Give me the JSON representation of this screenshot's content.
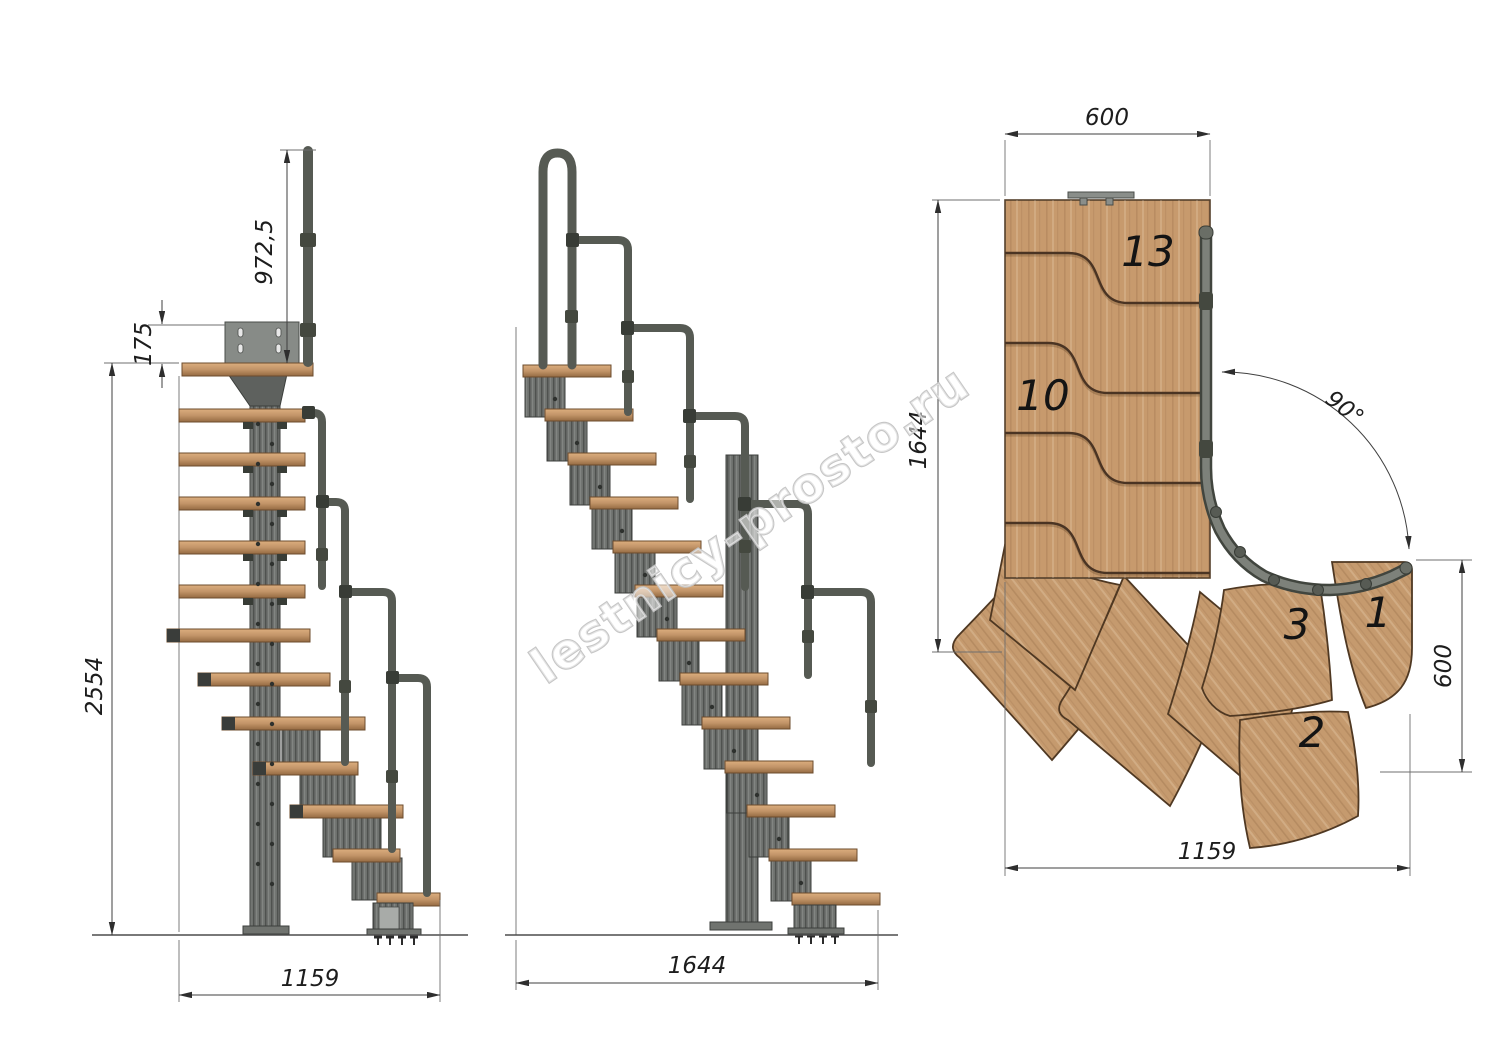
{
  "watermark": {
    "text": "lestnicy-prosto.ru"
  },
  "views": {
    "front": {
      "name": "front-elevation",
      "dims": {
        "handrail_height": "972,5",
        "mount_plate_height": "175",
        "total_height": "2554",
        "base_width": "1159"
      }
    },
    "side": {
      "name": "side-elevation",
      "dims": {
        "total_depth": "1644"
      }
    },
    "plan": {
      "name": "top-plan",
      "dims": {
        "flight_width": "600",
        "plan_depth": "1644",
        "turn_angle": "90°",
        "exit_width": "600",
        "plan_width": "1159"
      },
      "step_numbers": {
        "n13": "13",
        "n10": "10",
        "n3": "3",
        "n1": "1",
        "n2": "2"
      }
    }
  },
  "colors": {
    "background": "#ffffff",
    "wood_plan": "#c79a6d",
    "wood_grain": "#8a6038",
    "tread_light": "#d9ac7c",
    "tread_dark": "#936941",
    "metal": "#6e716e",
    "metal_dark": "#3f423f",
    "tube": "#565a53",
    "dim_line": "#3f3f3f",
    "text": "#1d1d1d",
    "watermark_outline": "#c3c3c3"
  }
}
